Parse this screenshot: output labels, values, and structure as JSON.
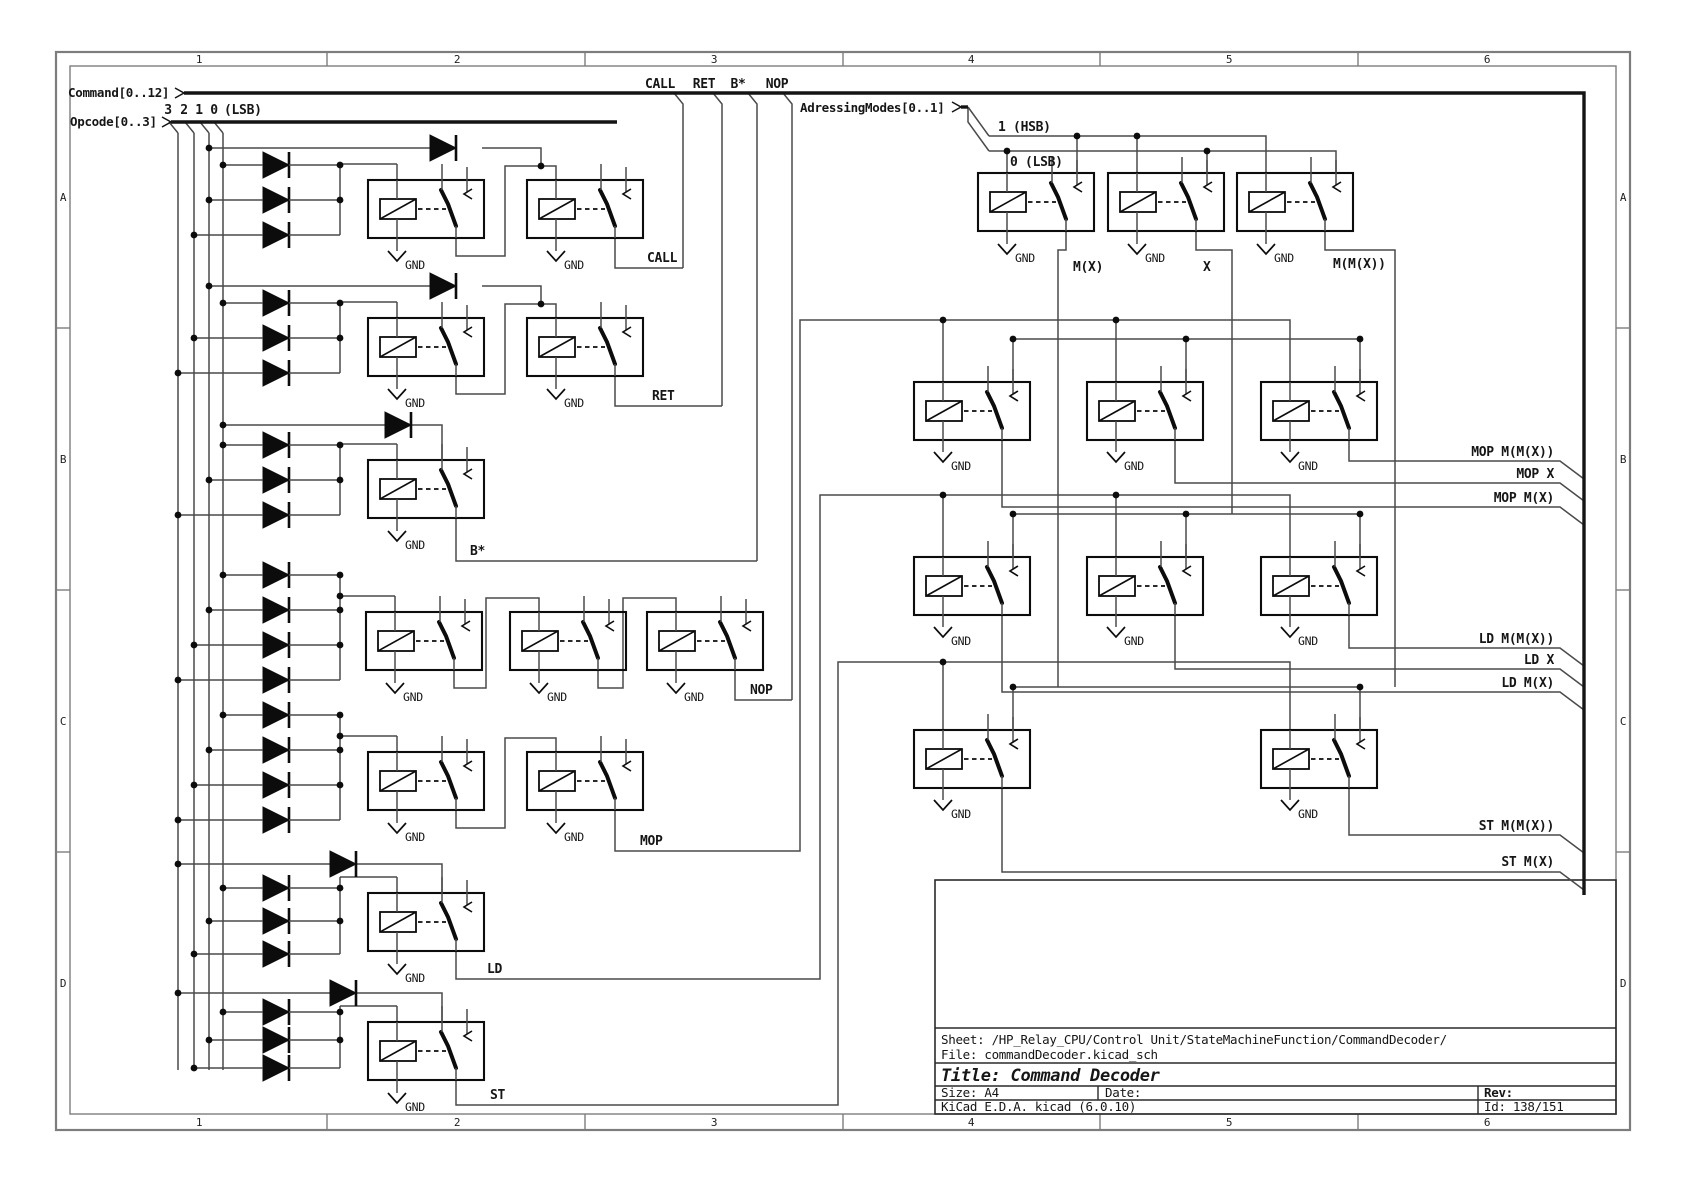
{
  "app": "KiCad schematic sheet",
  "title_block": {
    "sheet": "Sheet: /HP_Relay_CPU/Control Unit/StateMachineFunction/CommandDecoder/",
    "file": "File: commandDecoder.kicad_sch",
    "title": "Title: Command Decoder",
    "size_label": "Size: A4",
    "date_label": "Date:",
    "rev_label": "Rev:",
    "generator": "KiCad E.D.A.  kicad (6.0.10)",
    "id": "Id: 138/151"
  },
  "page_refs": {
    "columns": [
      "1",
      "2",
      "3",
      "4",
      "5",
      "6"
    ],
    "rows": [
      "A",
      "B",
      "C",
      "D"
    ],
    "col_x": [
      199,
      457,
      714,
      971,
      1229,
      1487
    ],
    "row_y": [
      201,
      463,
      725,
      987
    ],
    "tick_x": [
      327,
      585,
      843,
      1100,
      1358
    ],
    "tick_y": [
      328,
      590,
      852
    ]
  },
  "colors": {
    "wire": "#4a4a4a",
    "symbol": "#0c0c0c",
    "border": "#7d7d7d",
    "text": "#161616"
  },
  "schematic": {
    "bus_labels": [
      {
        "t": "Command[0..12]",
        "x": 68,
        "y": 97,
        "s": 12.5
      },
      {
        "t": "Opcode[0..3]",
        "x": 70,
        "y": 126,
        "s": 12.5
      },
      {
        "t": "AdressingModes[0..1]",
        "x": 800,
        "y": 112,
        "s": 12.5
      }
    ],
    "labels": [
      {
        "t": "3",
        "x": 168,
        "y": 114,
        "a": "middle"
      },
      {
        "t": "2",
        "x": 184,
        "y": 114,
        "a": "middle"
      },
      {
        "t": "1",
        "x": 199,
        "y": 114,
        "a": "middle"
      },
      {
        "t": "0",
        "x": 214,
        "y": 114,
        "a": "middle"
      },
      {
        "t": "(LSB)",
        "x": 224,
        "y": 114
      },
      {
        "t": "CALL",
        "x": 660,
        "y": 88,
        "a": "middle"
      },
      {
        "t": "RET",
        "x": 704,
        "y": 88,
        "a": "middle"
      },
      {
        "t": "B*",
        "x": 738,
        "y": 88,
        "a": "middle"
      },
      {
        "t": "NOP",
        "x": 777,
        "y": 88,
        "a": "middle"
      },
      {
        "t": "1 (HSB)",
        "x": 998,
        "y": 131
      },
      {
        "t": "0 (LSB)",
        "x": 1010,
        "y": 166
      },
      {
        "t": "M(X)",
        "x": 1073,
        "y": 271
      },
      {
        "t": "X",
        "x": 1203,
        "y": 271
      },
      {
        "t": "M(M(X))",
        "x": 1333,
        "y": 268
      },
      {
        "t": "CALL",
        "x": 647,
        "y": 262
      },
      {
        "t": "RET",
        "x": 652,
        "y": 400
      },
      {
        "t": "B*",
        "x": 470,
        "y": 555
      },
      {
        "t": "NOP",
        "x": 750,
        "y": 694
      },
      {
        "t": "MOP",
        "x": 640,
        "y": 845
      },
      {
        "t": "LD",
        "x": 487,
        "y": 973
      },
      {
        "t": "ST",
        "x": 490,
        "y": 1099
      },
      {
        "t": "MOP M(M(X))",
        "x": 1554,
        "y": 456,
        "a": "end"
      },
      {
        "t": "MOP X",
        "x": 1554,
        "y": 478,
        "a": "end"
      },
      {
        "t": "MOP M(X)",
        "x": 1554,
        "y": 502,
        "a": "end"
      },
      {
        "t": "LD M(M(X))",
        "x": 1554,
        "y": 643,
        "a": "end"
      },
      {
        "t": "LD X",
        "x": 1554,
        "y": 664,
        "a": "end"
      },
      {
        "t": "LD M(X)",
        "x": 1554,
        "y": 687,
        "a": "end"
      },
      {
        "t": "ST M(M(X))",
        "x": 1554,
        "y": 830,
        "a": "end"
      },
      {
        "t": "ST M(X)",
        "x": 1554,
        "y": 866,
        "a": "end"
      }
    ],
    "bus_arrows": [
      [
        175,
        88,
        184,
        93,
        175,
        98
      ],
      [
        162,
        117,
        171,
        122,
        162,
        127
      ],
      [
        952,
        102,
        961,
        107,
        952,
        112
      ]
    ],
    "buses": [
      [
        184,
        93,
        1584,
        93,
        1584,
        895
      ],
      [
        171,
        122,
        617,
        122
      ],
      [
        961,
        107,
        968,
        107
      ]
    ],
    "relays": [
      {
        "x": 368,
        "y": 180
      },
      {
        "x": 527,
        "y": 180
      },
      {
        "x": 368,
        "y": 318
      },
      {
        "x": 527,
        "y": 318
      },
      {
        "x": 368,
        "y": 460
      },
      {
        "x": 366,
        "y": 612
      },
      {
        "x": 510,
        "y": 612
      },
      {
        "x": 647,
        "y": 612
      },
      {
        "x": 368,
        "y": 752
      },
      {
        "x": 527,
        "y": 752
      },
      {
        "x": 368,
        "y": 893
      },
      {
        "x": 368,
        "y": 1022
      },
      {
        "x": 978,
        "y": 173
      },
      {
        "x": 1108,
        "y": 173
      },
      {
        "x": 1237,
        "y": 173
      },
      {
        "x": 914,
        "y": 382
      },
      {
        "x": 1087,
        "y": 382
      },
      {
        "x": 1261,
        "y": 382
      },
      {
        "x": 914,
        "y": 557
      },
      {
        "x": 1087,
        "y": 557
      },
      {
        "x": 1261,
        "y": 557
      },
      {
        "x": 914,
        "y": 730
      },
      {
        "x": 1261,
        "y": 730
      }
    ],
    "diodes": [
      {
        "x": 263,
        "y": 165,
        "tap": 223
      },
      {
        "x": 263,
        "y": 200,
        "tap": 209
      },
      {
        "x": 263,
        "y": 235,
        "tap": 194
      },
      {
        "x": 263,
        "y": 303,
        "tap": 223
      },
      {
        "x": 263,
        "y": 338,
        "tap": 194
      },
      {
        "x": 263,
        "y": 373,
        "tap": 178
      },
      {
        "x": 263,
        "y": 445,
        "tap": 223
      },
      {
        "x": 263,
        "y": 480,
        "tap": 209
      },
      {
        "x": 263,
        "y": 515,
        "tap": 178
      },
      {
        "x": 263,
        "y": 575,
        "tap": 223
      },
      {
        "x": 263,
        "y": 610,
        "tap": 209
      },
      {
        "x": 263,
        "y": 645,
        "tap": 194
      },
      {
        "x": 263,
        "y": 680,
        "tap": 178
      },
      {
        "x": 263,
        "y": 715,
        "tap": 223
      },
      {
        "x": 263,
        "y": 750,
        "tap": 209
      },
      {
        "x": 263,
        "y": 785,
        "tap": 194
      },
      {
        "x": 263,
        "y": 820,
        "tap": 178
      },
      {
        "x": 263,
        "y": 888,
        "tap": 223
      },
      {
        "x": 263,
        "y": 921,
        "tap": 209
      },
      {
        "x": 263,
        "y": 954,
        "tap": 194
      },
      {
        "x": 263,
        "y": 1012,
        "tap": 223
      },
      {
        "x": 263,
        "y": 1040,
        "tap": 209
      },
      {
        "x": 263,
        "y": 1068,
        "tap": 194
      }
    ],
    "free_diodes": [
      {
        "x": 430,
        "y": 148
      },
      {
        "x": 430,
        "y": 286
      },
      {
        "x": 385,
        "y": 425
      },
      {
        "x": 330,
        "y": 864
      },
      {
        "x": 330,
        "y": 993
      }
    ],
    "gnds": [
      {
        "x": 397,
        "y": 238
      },
      {
        "x": 556,
        "y": 238
      },
      {
        "x": 397,
        "y": 376
      },
      {
        "x": 556,
        "y": 376
      },
      {
        "x": 397,
        "y": 518
      },
      {
        "x": 395,
        "y": 670
      },
      {
        "x": 539,
        "y": 670
      },
      {
        "x": 676,
        "y": 670
      },
      {
        "x": 397,
        "y": 810
      },
      {
        "x": 556,
        "y": 810
      },
      {
        "x": 397,
        "y": 951
      },
      {
        "x": 397,
        "y": 1080
      },
      {
        "x": 1007,
        "y": 231
      },
      {
        "x": 1137,
        "y": 231
      },
      {
        "x": 1266,
        "y": 231
      },
      {
        "x": 943,
        "y": 439
      },
      {
        "x": 1116,
        "y": 439
      },
      {
        "x": 1290,
        "y": 439
      },
      {
        "x": 943,
        "y": 614
      },
      {
        "x": 1116,
        "y": 614
      },
      {
        "x": 1290,
        "y": 614
      },
      {
        "x": 943,
        "y": 787
      },
      {
        "x": 1290,
        "y": 787
      }
    ],
    "gnd_text": "GND",
    "wires": [
      [
        169,
        122,
        178,
        133
      ],
      [
        178,
        133,
        178,
        1070
      ],
      [
        185,
        122,
        194,
        133
      ],
      [
        194,
        133,
        194,
        1070
      ],
      [
        200,
        122,
        209,
        133
      ],
      [
        209,
        133,
        209,
        1070
      ],
      [
        214,
        122,
        223,
        133
      ],
      [
        223,
        133,
        223,
        1070
      ],
      [
        674,
        93,
        683,
        104,
        683,
        268
      ],
      [
        713,
        93,
        722,
        104,
        722,
        406
      ],
      [
        748,
        93,
        757,
        104,
        757,
        561
      ],
      [
        783,
        93,
        792,
        104,
        792,
        700
      ],
      [
        968,
        107,
        989,
        136
      ],
      [
        968,
        107,
        968,
        122,
        989,
        151
      ],
      [
        989,
        136,
        1266,
        136,
        1266,
        173
      ],
      [
        989,
        151,
        1336,
        151,
        1336,
        173
      ],
      [
        1007,
        151,
        1007,
        173
      ],
      [
        1077,
        136,
        1077,
        173
      ],
      [
        1137,
        136,
        1137,
        173
      ],
      [
        1207,
        151,
        1207,
        173
      ],
      [
        1066,
        231,
        1066,
        250,
        1058,
        250,
        1058,
        687
      ],
      [
        1196,
        231,
        1196,
        250,
        1232,
        250,
        1232,
        514
      ],
      [
        1325,
        231,
        1325,
        250,
        1395,
        250,
        1395,
        687
      ],
      [
        1013,
        339,
        1360,
        339
      ],
      [
        1013,
        339,
        1013,
        382
      ],
      [
        1186,
        339,
        1186,
        382
      ],
      [
        1360,
        339,
        1360,
        382
      ],
      [
        1013,
        514,
        1360,
        514
      ],
      [
        1013,
        514,
        1013,
        557
      ],
      [
        1186,
        514,
        1186,
        557
      ],
      [
        1360,
        514,
        1360,
        557
      ],
      [
        1013,
        687,
        1360,
        687
      ],
      [
        1013,
        687,
        1013,
        730
      ],
      [
        1360,
        687,
        1360,
        730
      ],
      [
        615,
        810,
        615,
        851,
        800,
        851,
        800,
        320,
        1290,
        320,
        1290,
        382
      ],
      [
        943,
        320,
        943,
        382
      ],
      [
        1116,
        320,
        1116,
        382
      ],
      [
        456,
        951,
        456,
        979,
        820,
        979,
        820,
        495,
        1290,
        495,
        1290,
        557
      ],
      [
        943,
        495,
        943,
        557
      ],
      [
        1116,
        495,
        1116,
        557
      ],
      [
        456,
        1080,
        456,
        1105,
        838,
        1105,
        838,
        662,
        1290,
        662,
        1290,
        730
      ],
      [
        943,
        662,
        943,
        730
      ],
      [
        1002,
        439,
        1002,
        507,
        1560,
        507,
        1584,
        525
      ],
      [
        1175,
        439,
        1175,
        483,
        1560,
        483,
        1584,
        501
      ],
      [
        1349,
        439,
        1349,
        461,
        1560,
        461,
        1584,
        479
      ],
      [
        1002,
        614,
        1002,
        692,
        1560,
        692,
        1584,
        710
      ],
      [
        1175,
        614,
        1175,
        669,
        1560,
        669,
        1584,
        687
      ],
      [
        1349,
        614,
        1349,
        648,
        1560,
        648,
        1584,
        666
      ],
      [
        1002,
        787,
        1002,
        872,
        1560,
        872,
        1584,
        890
      ],
      [
        1349,
        787,
        1349,
        835,
        1560,
        835,
        1584,
        853
      ],
      [
        615,
        238,
        615,
        268,
        683,
        268
      ],
      [
        615,
        376,
        615,
        406,
        722,
        406
      ],
      [
        456,
        518,
        456,
        561,
        757,
        561
      ],
      [
        735,
        670,
        735,
        700,
        792,
        700
      ],
      [
        456,
        238,
        456,
        256,
        505,
        256,
        505,
        166,
        556,
        166,
        556,
        180
      ],
      [
        456,
        376,
        456,
        394,
        505,
        394,
        505,
        304,
        556,
        304,
        556,
        318
      ],
      [
        456,
        810,
        456,
        828,
        505,
        828,
        505,
        738,
        556,
        738,
        556,
        752
      ],
      [
        454,
        670,
        454,
        688,
        486,
        688,
        486,
        598,
        539,
        598,
        539,
        612
      ],
      [
        598,
        670,
        598,
        688,
        623,
        688,
        623,
        598,
        676,
        598,
        676,
        612
      ],
      [
        340,
        164,
        340,
        235
      ],
      [
        340,
        164,
        397,
        164
      ],
      [
        397,
        164,
        397,
        180
      ],
      [
        340,
        302,
        340,
        373
      ],
      [
        340,
        302,
        397,
        302
      ],
      [
        397,
        302,
        397,
        318
      ],
      [
        340,
        444,
        340,
        515
      ],
      [
        340,
        444,
        397,
        444
      ],
      [
        397,
        444,
        397,
        460
      ],
      [
        340,
        575,
        340,
        680
      ],
      [
        340,
        596,
        395,
        596
      ],
      [
        395,
        596,
        395,
        612
      ],
      [
        340,
        715,
        340,
        820
      ],
      [
        340,
        736,
        397,
        736
      ],
      [
        397,
        736,
        397,
        752
      ],
      [
        340,
        877,
        340,
        954
      ],
      [
        340,
        877,
        397,
        877
      ],
      [
        397,
        877,
        397,
        893
      ],
      [
        340,
        1006,
        340,
        1068
      ],
      [
        340,
        1006,
        397,
        1006
      ],
      [
        397,
        1006,
        397,
        1022
      ],
      [
        209,
        148,
        430,
        148
      ],
      [
        482,
        148,
        541,
        148,
        541,
        166
      ],
      [
        209,
        286,
        430,
        286
      ],
      [
        482,
        286,
        541,
        286,
        541,
        304
      ],
      [
        223,
        425,
        385,
        425
      ],
      [
        411,
        425,
        442,
        425,
        442,
        460
      ],
      [
        178,
        864,
        330,
        864
      ],
      [
        356,
        864,
        442,
        864,
        442,
        893
      ],
      [
        178,
        993,
        330,
        993
      ],
      [
        356,
        993,
        442,
        993,
        442,
        1022
      ]
    ],
    "dots": [
      [
        223,
        165
      ],
      [
        209,
        200
      ],
      [
        194,
        235
      ],
      [
        223,
        303
      ],
      [
        194,
        338
      ],
      [
        178,
        373
      ],
      [
        223,
        445
      ],
      [
        209,
        480
      ],
      [
        178,
        515
      ],
      [
        223,
        575
      ],
      [
        209,
        610
      ],
      [
        194,
        645
      ],
      [
        178,
        680
      ],
      [
        223,
        715
      ],
      [
        209,
        750
      ],
      [
        194,
        785
      ],
      [
        178,
        820
      ],
      [
        223,
        888
      ],
      [
        209,
        921
      ],
      [
        194,
        954
      ],
      [
        223,
        1012
      ],
      [
        209,
        1040
      ],
      [
        194,
        1068
      ],
      [
        340,
        165
      ],
      [
        340,
        200
      ],
      [
        340,
        303
      ],
      [
        340,
        338
      ],
      [
        340,
        445
      ],
      [
        340,
        480
      ],
      [
        340,
        575
      ],
      [
        340,
        596
      ],
      [
        340,
        610
      ],
      [
        340,
        645
      ],
      [
        340,
        715
      ],
      [
        340,
        736
      ],
      [
        340,
        750
      ],
      [
        340,
        785
      ],
      [
        340,
        888
      ],
      [
        340,
        921
      ],
      [
        340,
        1012
      ],
      [
        340,
        1040
      ],
      [
        209,
        148
      ],
      [
        541,
        166
      ],
      [
        209,
        286
      ],
      [
        541,
        304
      ],
      [
        223,
        425
      ],
      [
        178,
        864
      ],
      [
        178,
        993
      ],
      [
        1077,
        136
      ],
      [
        1137,
        136
      ],
      [
        1007,
        151
      ],
      [
        1207,
        151
      ],
      [
        1013,
        339
      ],
      [
        1186,
        339
      ],
      [
        1360,
        339
      ],
      [
        1013,
        514
      ],
      [
        1186,
        514
      ],
      [
        1360,
        514
      ],
      [
        1013,
        687
      ],
      [
        1360,
        687
      ],
      [
        943,
        320
      ],
      [
        1116,
        320
      ],
      [
        943,
        495
      ],
      [
        1116,
        495
      ],
      [
        943,
        662
      ]
    ]
  }
}
